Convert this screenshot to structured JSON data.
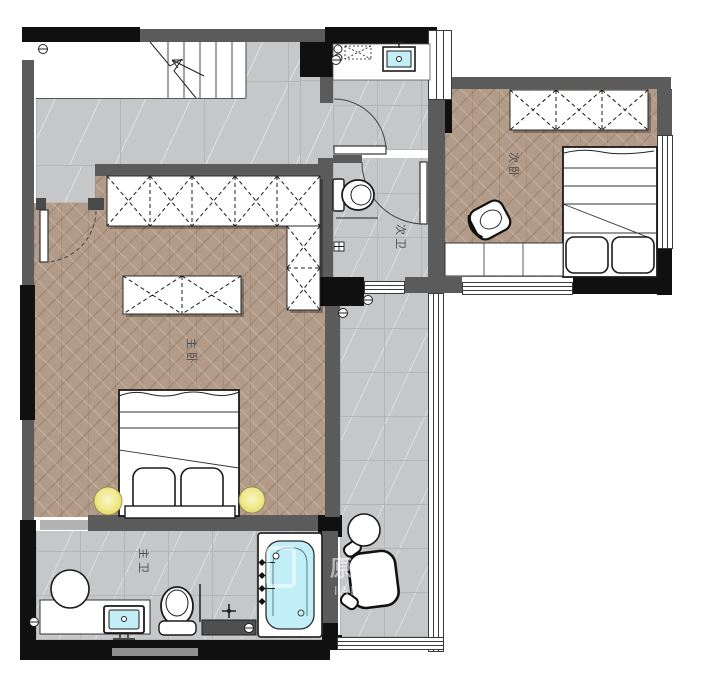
{
  "plan": {
    "rooms": [
      {
        "name": "master-bedroom",
        "label": "主卧",
        "floor": "wood-herringbone"
      },
      {
        "name": "master-bathroom",
        "label": "主卫",
        "floor": "gray-tile"
      },
      {
        "name": "second-bedroom",
        "label": "次卧",
        "floor": "wood-herringbone"
      },
      {
        "name": "second-bathroom",
        "label": "次卫",
        "floor": "gray-tile"
      }
    ],
    "watermark": {
      "cn": "原创",
      "en": "IALS"
    },
    "colors": {
      "wall_gray": "#5b5b5b",
      "wall_black": "#101010",
      "tile_floor": "#c6c7c9",
      "wood_floor": "#b29b88",
      "fixture_water": "#c2eef8",
      "lamp_glow": "#efe98d",
      "paper": "#ffffff"
    },
    "fixtures": [
      "staircase",
      "wardrobe",
      "island-wardrobe",
      "double-bed",
      "single-bed",
      "nightstand-lamp",
      "toilet",
      "washbasin",
      "vanity-counter",
      "vanity-stool",
      "bathtub",
      "shower-mixer",
      "faucet-cross",
      "armchair",
      "side-table",
      "desk-chair",
      "desk-cabinet",
      "washing-machine",
      "floor-drain",
      "door-swing",
      "window",
      "floor-drain-symbol"
    ]
  }
}
